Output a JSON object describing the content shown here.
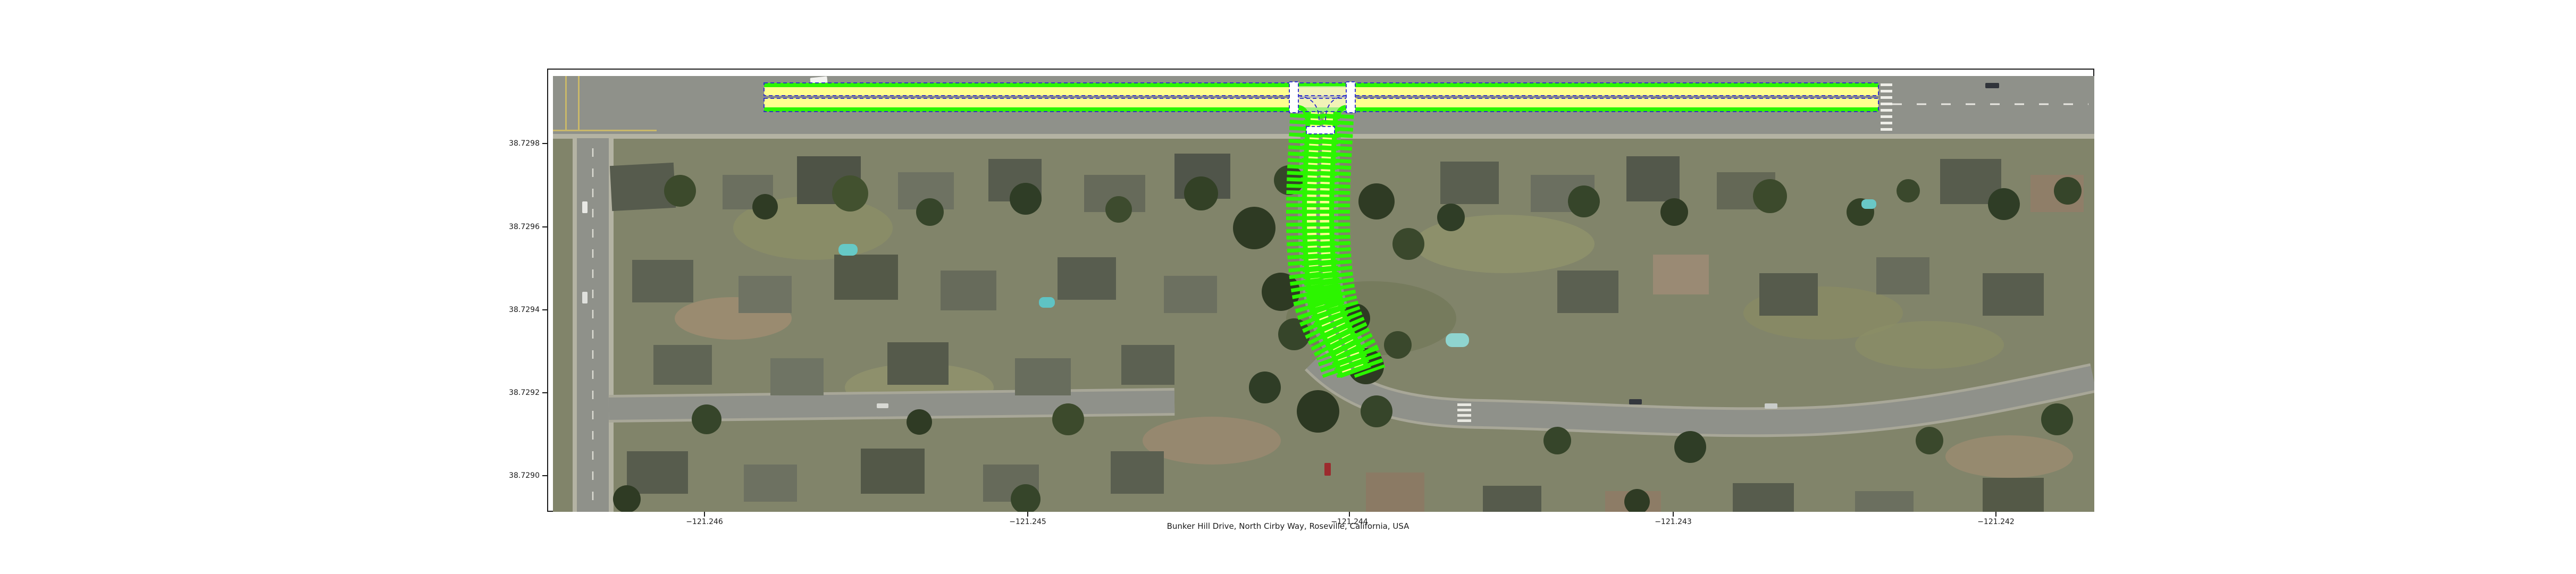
{
  "figure": {
    "caption": "Bunker Hill Drive, North Cirby Way, Roseville, California, USA"
  },
  "axes": {
    "x_ticks": [
      "−121.246",
      "−121.245",
      "−121.244",
      "−121.243",
      "−121.242"
    ],
    "y_ticks": [
      "38.7298",
      "38.7296",
      "38.7294",
      "38.7292",
      "38.7290"
    ]
  },
  "map_overlay": {
    "kind": "lanelet lane markings over aerial imagery",
    "roads": [
      "North Cirby Way (east-west)",
      "Bunker Hill Drive (north-south)"
    ]
  },
  "theme": {
    "figure-bg": "#ffffff",
    "frame": "#1b1b1b",
    "text": "#1a1a1a",
    "lane-fill": "#ffff8e",
    "lane-edge": "#2cf500",
    "lane-boundary": "#2626cf",
    "crosswalk": "#ffffff",
    "road-gray": "#8f918a",
    "sidewalk": "#b4b3a3",
    "aerial-base": "#81846a"
  }
}
